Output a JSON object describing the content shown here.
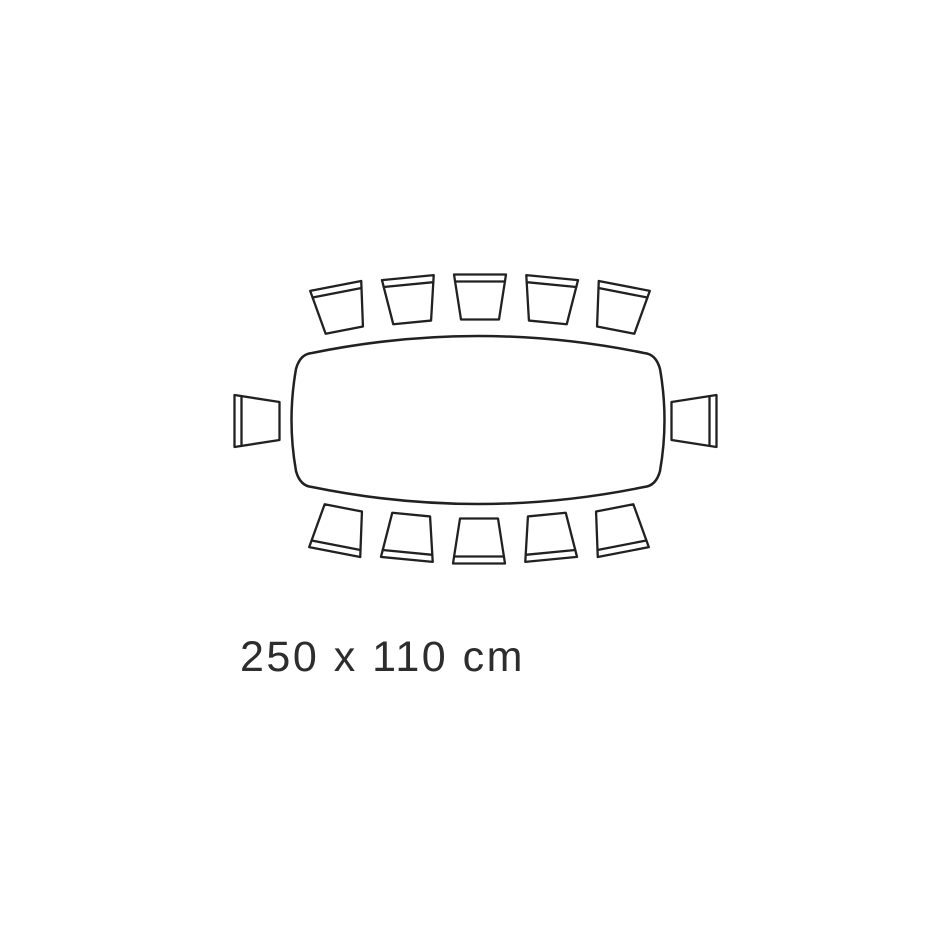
{
  "diagram": {
    "type": "dining-table-seating-plan",
    "label": "250 x 110 cm",
    "table": {
      "width_cm": 250,
      "depth_cm": 110,
      "shape": "rounded rectangle with slightly bowed edges",
      "path": "M312 353 Q478 319 644 353 Q656 354 660 369 Q669 420 660 471 Q656 486 644 487 Q478 521 312 487 Q300 486 296 471 Q287 420 296 369 Q300 354 312 353 Z"
    },
    "stroke_color": "#212121",
    "table_stroke_width": 2.5,
    "chair_stroke_width": 2.3,
    "seats": {
      "total": 12,
      "top_row": 5,
      "bottom_row": 5,
      "left_end": 1,
      "right_end": 1
    },
    "chair_shape": {
      "top_width": 52,
      "bottom_width": 38,
      "height": 45,
      "backrest_offset": 7
    },
    "chairs": [
      {
        "id": "top-1",
        "x": 340,
        "y": 308,
        "rotation": -11
      },
      {
        "id": "top-2",
        "x": 410,
        "y": 300,
        "rotation": -5.5
      },
      {
        "id": "top-3",
        "x": 480,
        "y": 297,
        "rotation": 0
      },
      {
        "id": "top-4",
        "x": 550,
        "y": 300,
        "rotation": 5.5
      },
      {
        "id": "top-5",
        "x": 620,
        "y": 308,
        "rotation": 11
      },
      {
        "id": "end-left",
        "x": 257,
        "y": 421,
        "rotation": -90
      },
      {
        "id": "end-right",
        "x": 694,
        "y": 421,
        "rotation": 90
      },
      {
        "id": "bottom-1",
        "x": 339,
        "y": 530,
        "rotation": 191
      },
      {
        "id": "bottom-2",
        "x": 409,
        "y": 537,
        "rotation": 185.5
      },
      {
        "id": "bottom-3",
        "x": 479,
        "y": 541,
        "rotation": 180
      },
      {
        "id": "bottom-4",
        "x": 549,
        "y": 537,
        "rotation": 174.5
      },
      {
        "id": "bottom-5",
        "x": 619,
        "y": 530,
        "rotation": 169
      }
    ]
  }
}
